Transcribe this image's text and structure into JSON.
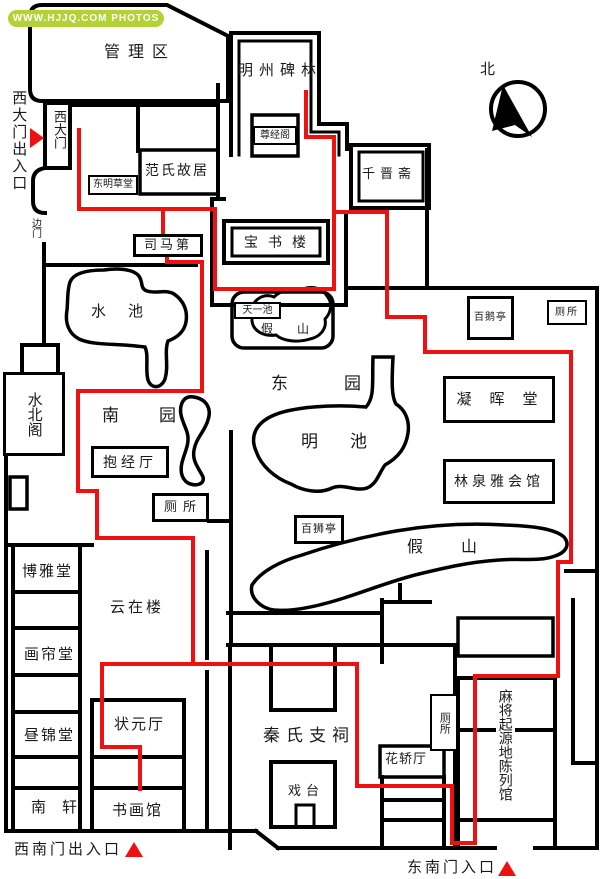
{
  "watermark": {
    "text": "WWW.HJJQ.COM PHOTOS"
  },
  "compass": {
    "label": "北"
  },
  "colors": {
    "wall": "#000000",
    "route": "#ee1111",
    "badge_bg": "#b2d235",
    "badge_text": "#ffffff",
    "gate_marker": "#ee1111"
  },
  "gates": {
    "west": "西大门出入口",
    "west_gate": "西大门",
    "side": "边门",
    "southwest": "西南门出入口",
    "southeast": "东南门入口"
  },
  "areas": {
    "management": "管理区",
    "south_garden": "南园",
    "east_garden": "东园"
  },
  "water": {
    "west_pond": "水池",
    "tianyi_pond": "天一池",
    "ming_pond": "明池"
  },
  "rockery": {
    "north": "假山",
    "south": "假山"
  },
  "buildings": {
    "stele_forest": "明州碑林",
    "zunjingge": "尊经阁",
    "qianjinzhai": "千晋斋",
    "fan_residence": "范氏故居",
    "dongming_cottage": "东明草堂",
    "simadi": "司马第",
    "baoshulou": "宝书楼",
    "baieting": "百鹅亭",
    "shuibeige": "水北阁",
    "ninghuitang": "凝晖堂",
    "baojingting": "抱经厅",
    "linquan_club": "林泉雅会馆",
    "baishiting": "百狮亭",
    "boyatang": "博雅堂",
    "yunzailou": "云在楼",
    "hualiantang": "画帘堂",
    "zhoujintang": "昼锦堂",
    "zhuangyuan_hall": "状元厅",
    "nanxuan": "南轩",
    "shuhuaguan": "书画馆",
    "qin_ancestral_hall": "秦氏支祠",
    "stage": "戏台",
    "huajiaoting": "花轿厅",
    "mahjong_museum": "麻将起源地陈列馆"
  },
  "toilets": {
    "northeast": "厕所",
    "west": "厕所",
    "southeast": "厕所"
  }
}
